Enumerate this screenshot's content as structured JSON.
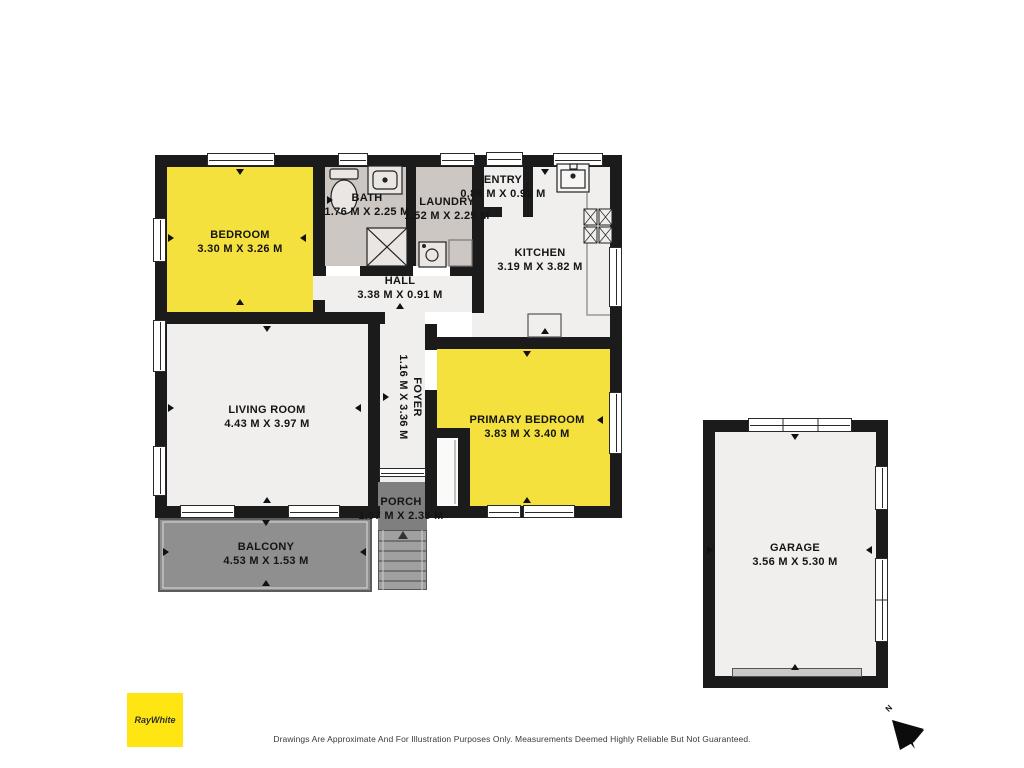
{
  "rooms": [
    {
      "name": "BEDROOM",
      "dims": "3.30 M X 3.26 M"
    },
    {
      "name": "BATH",
      "dims": "1.76 M X 2.25 M"
    },
    {
      "name": "LAUNDRY",
      "dims": "1.52 M X 2.25 M"
    },
    {
      "name": "ENTRY",
      "dims": "0.86 M X 0.92 M"
    },
    {
      "name": "KITCHEN",
      "dims": "3.19 M X 3.82 M"
    },
    {
      "name": "HALL",
      "dims": "3.38 M X 0.91 M"
    },
    {
      "name": "LIVING ROOM",
      "dims": "4.43 M X 3.97 M"
    },
    {
      "name": "FOYER",
      "dims": "1.16 M X 3.36 M"
    },
    {
      "name": "PRIMARY BEDROOM",
      "dims": "3.83 M X 3.40 M"
    },
    {
      "name": "PORCH",
      "dims": "1.07 M X 2.35 M"
    },
    {
      "name": "BALCONY",
      "dims": "4.53 M X 1.53 M"
    },
    {
      "name": "GARAGE",
      "dims": "3.56 M X 5.30 M"
    }
  ],
  "branding": {
    "logo_text": "RayWhite",
    "logo_bg": "#FFE512"
  },
  "compass": {
    "label": "N"
  },
  "footer": {
    "disclaimer": "Drawings Are Approximate And For Illustration Purposes Only. Measurements Deemed Highly Reliable But Not Guaranteed."
  },
  "colors": {
    "wall": "#1B1B1B",
    "floor": "#F0EFED",
    "highlight_room": "#F5E13E",
    "wet_room": "#CDC7C3",
    "balcony": "#8F8F8F",
    "porch": "#7F7F7F",
    "stairs": "#A0A0A0",
    "garage_door": "#C9C9C9"
  }
}
